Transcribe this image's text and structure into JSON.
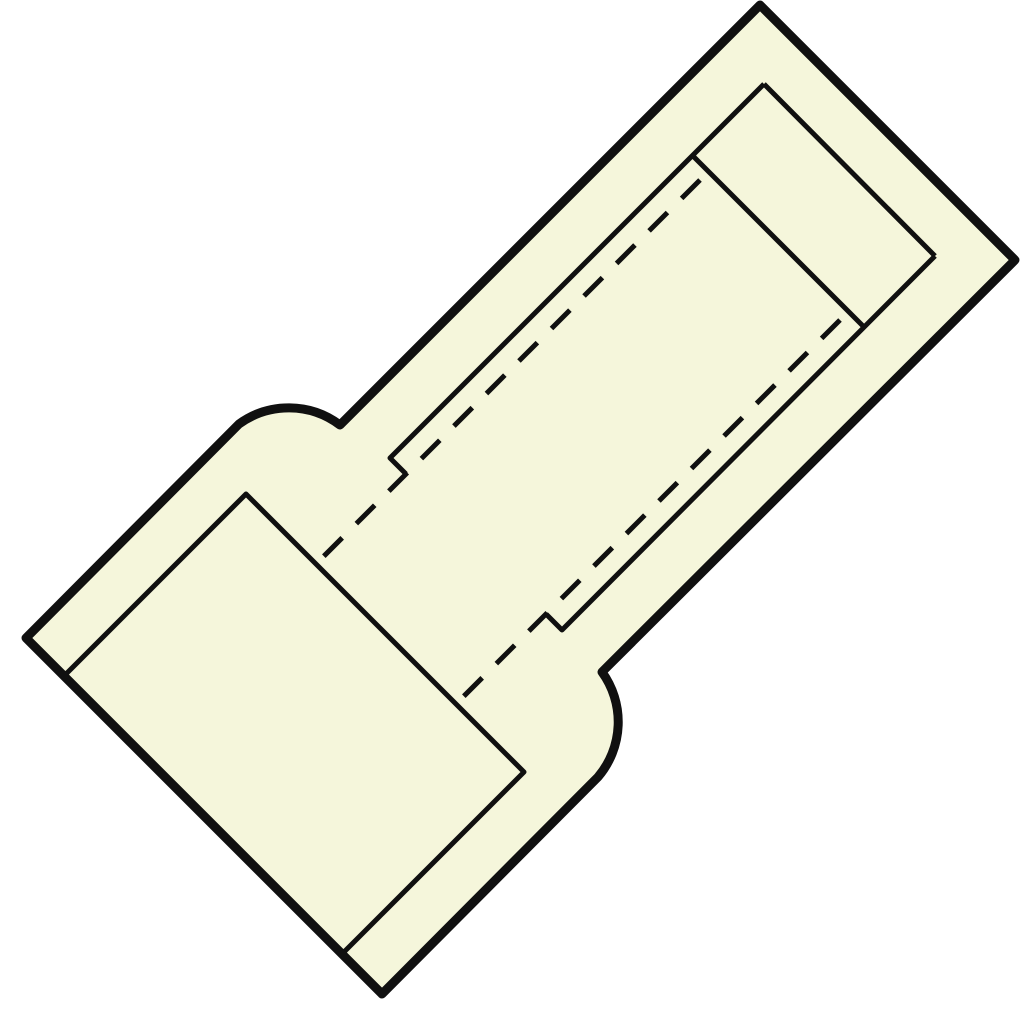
{
  "canvas": {
    "width": 1024,
    "height": 1024,
    "background": "#ffffff"
  },
  "style": {
    "body_fill": "#f5f6db",
    "line_color": "#101010",
    "outline_width": 9,
    "detail_width": 5,
    "dash_pattern": "26 20"
  },
  "shapes": {
    "body_outline": {
      "d": "M 26,638 L 239,424 A 85 85 0 0 1 340,425 L 760,5 L 1015,260 L 602,672 A 85 85 0 0 1 598,777 L 382,994 Z"
    },
    "bore_end_edge": {
      "d": "M 764,84 L 935,256"
    },
    "bore_left_edge": {
      "d": "M 406,474 L 390,458 L 764,84"
    },
    "bore_right_edge": {
      "d": "M 546,614 L 562,630 L 935,256"
    },
    "tube_end_edge": {
      "d": "M 692,155 L 864,327"
    },
    "sleeve_bore_edge": {
      "d": "M 64,676 L 246,494 L 524,772 L 342,954"
    },
    "hidden_tube_left": {
      "d": "M 700,180 L 316,564"
    },
    "hidden_tube_right": {
      "d": "M 840,320 L 456,704"
    }
  }
}
